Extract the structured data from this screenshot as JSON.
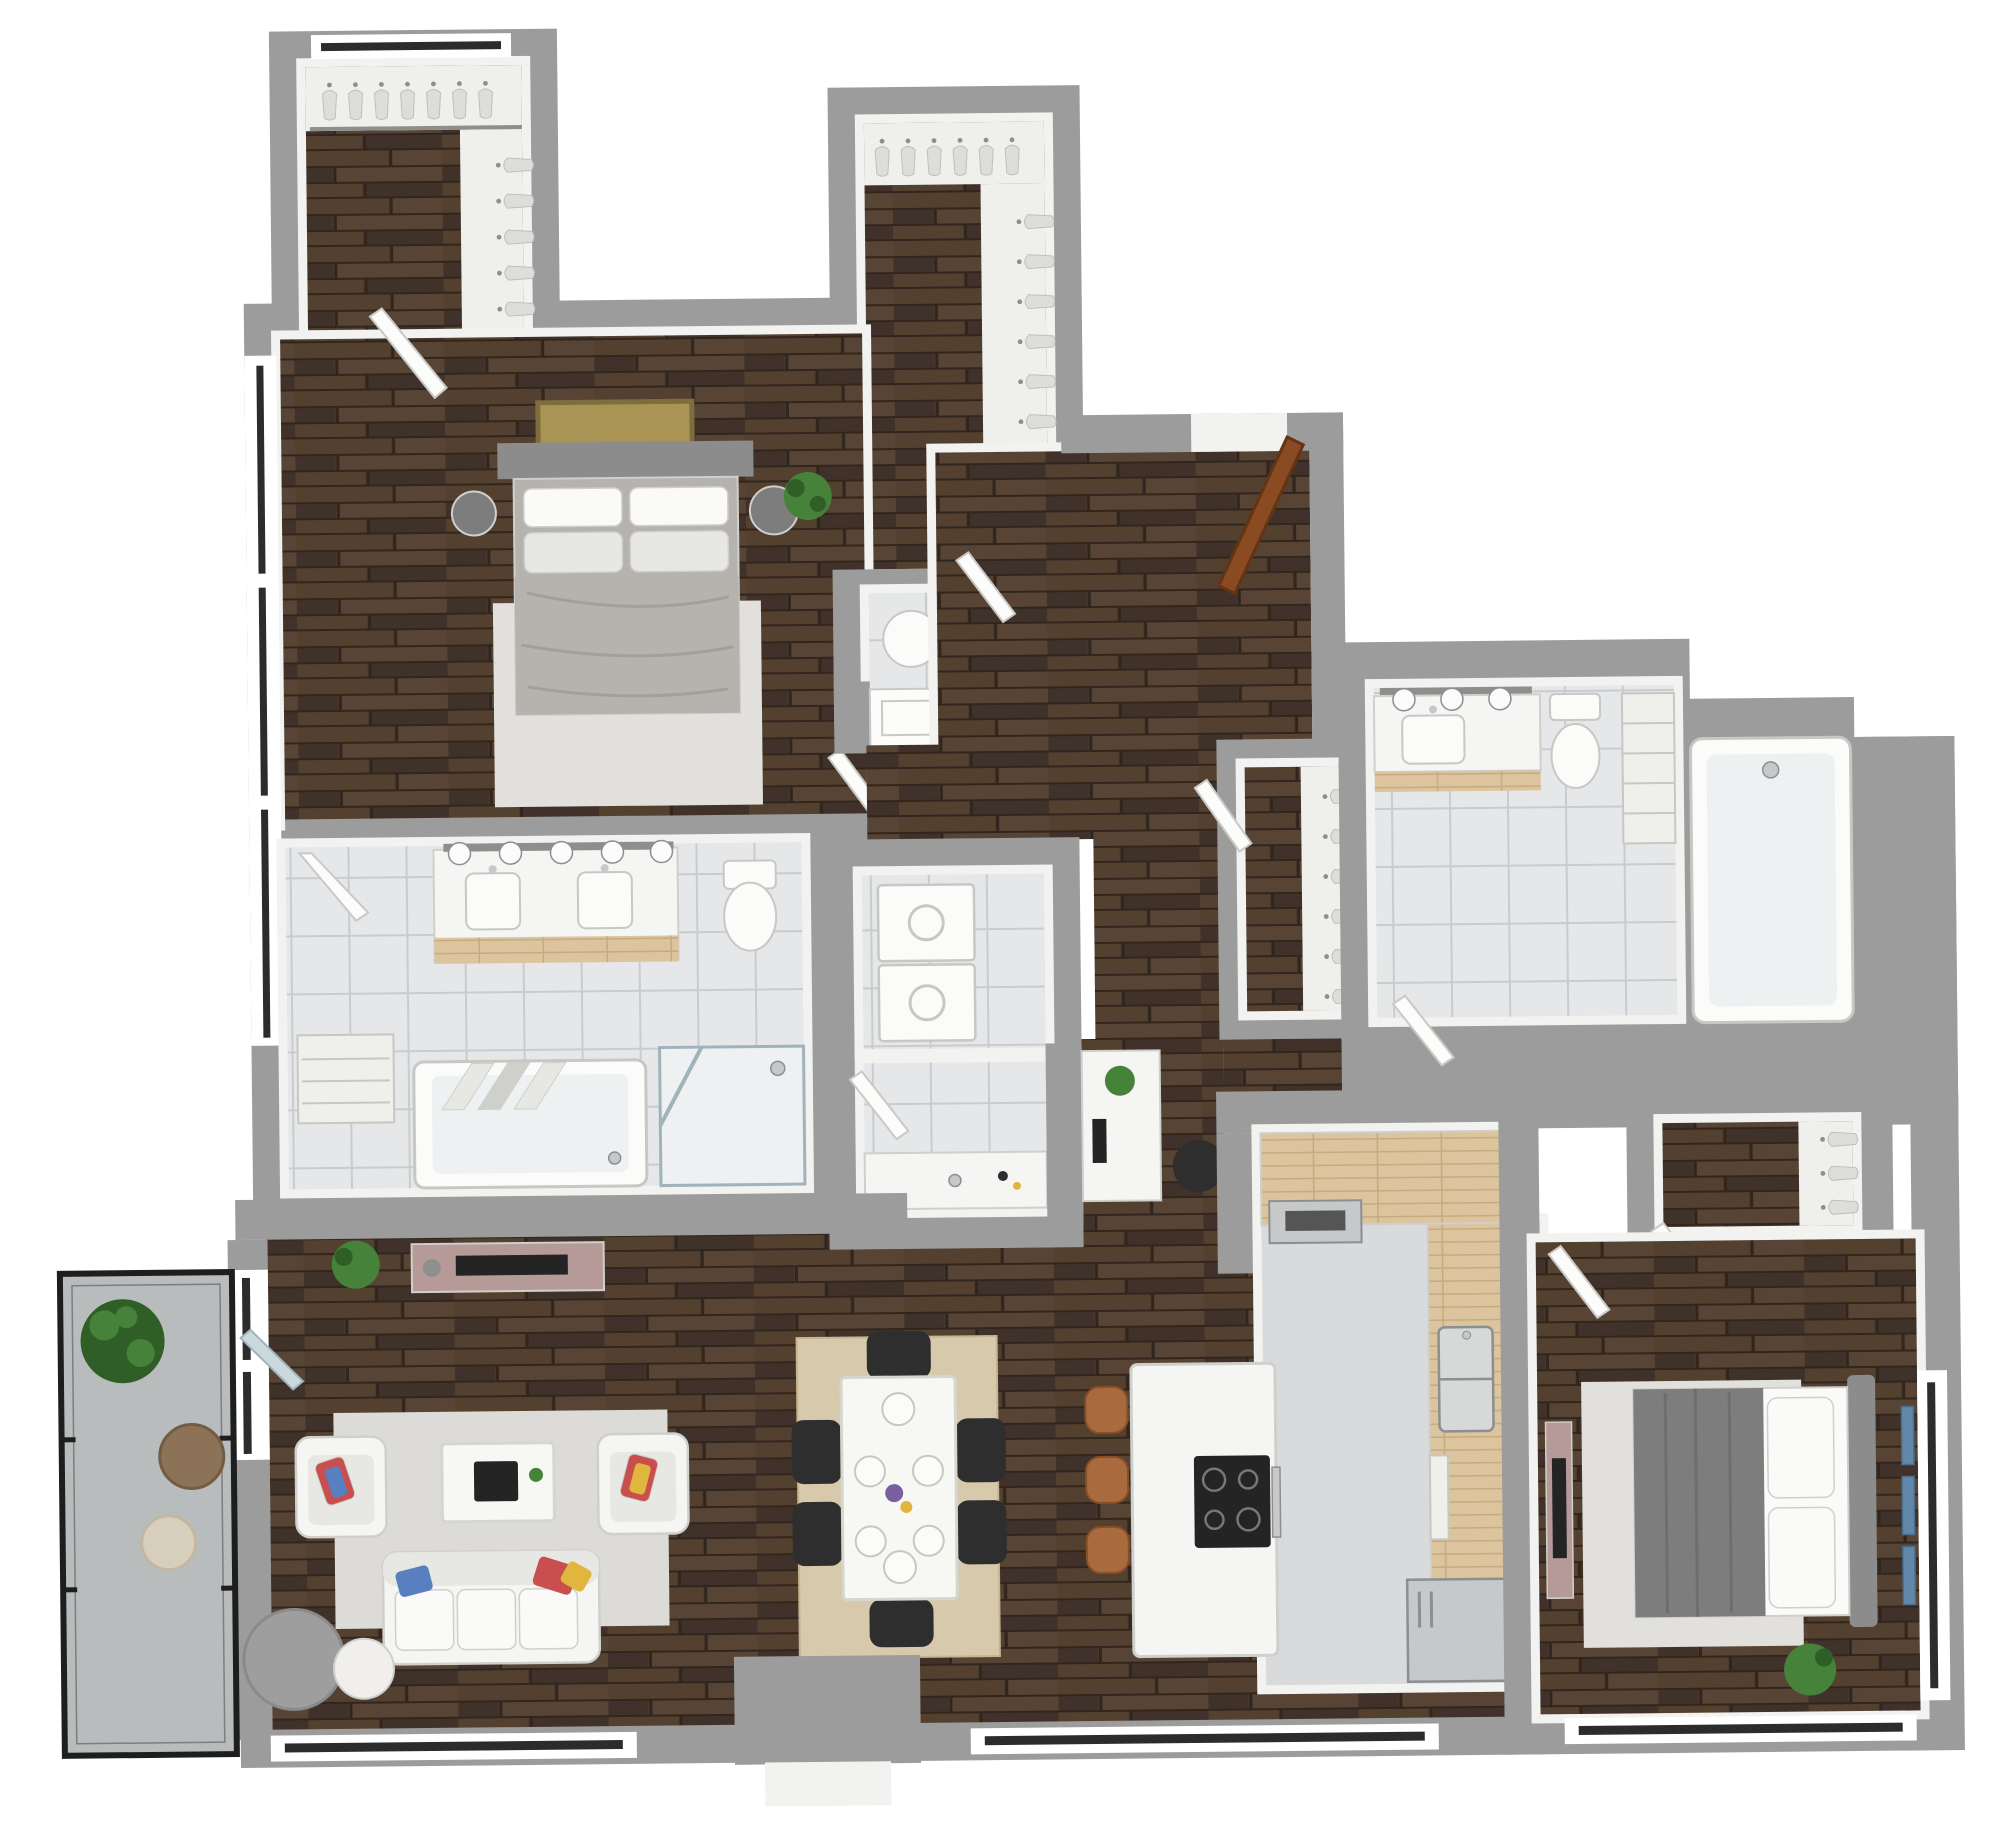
{
  "document": {
    "title": "3D Apartment Floor Plan Rendering",
    "view": "top-down 3d dollhouse render",
    "background": "#ffffff"
  },
  "colors": {
    "background": "#ffffff",
    "wall": "#9c9c9c",
    "wallFace": "#f2f2f0",
    "woodBase": "#4a392d",
    "woodPlankA": "#53402f",
    "woodPlankB": "#40322a",
    "woodPlankC": "#574434",
    "woodGap": "#31261d",
    "tileBase": "#e6e7e9",
    "tileLine": "#c9ccce",
    "counterWood": "#dcc49e",
    "counterGrain": "#c6ab7e",
    "aisleFloor": "#d9dadb",
    "balconyFloor": "#b8bcbd",
    "balconyFrame": "#1e1e1e",
    "whiteFurniture": "#f5f5f3",
    "furnitureShadow": "#cfcfcb",
    "grayDrum": "#9e9e9e",
    "black": "#2e2e2e",
    "bedHeadboard": "#8c8c8c",
    "duvetLight": "#b6b3af",
    "duvetDark": "#7d7d7d",
    "pillowWhite": "#fafaf9",
    "cushionGray": "#e7e7e3",
    "rugLight": "#dcdbd7",
    "rugJute": "#d7c9ab",
    "rugBedroom": "#e1e0dc",
    "mauve": "#b69a98",
    "tvBlack": "#242424",
    "plantGreen": "#47823a",
    "plantDark": "#2f5f27",
    "doorBrown": "#8a4a22",
    "doorLeafWhite": "#fcfcfb",
    "doorLeafEdge": "#c9c9c6",
    "glassBlue": "#ccd9dc",
    "glassLine": "#9fb4ba",
    "steel": "#c6c8c9",
    "steelDark": "#8b8f91",
    "artGold": "#a99455",
    "artGoldFrame": "#7e6e3e",
    "artBlue": "#6188a8",
    "marble": "#f7f7f4",
    "marbleVein": "#d6d6d1",
    "windowGlass": "#2c2c2c",
    "windowSill": "#ffffff",
    "clothesBody": "#dedddb",
    "clothesEdge": "#bfbfbc",
    "rodGray": "#8e8e8c",
    "stoolBrown": "#a96a3e",
    "stoolEdge": "#854f28",
    "accentRed": "#c94f4f",
    "accentBlue": "#5a7fc0",
    "accentYellow": "#e0b63f",
    "fixtureWhite": "#fbfbfa",
    "fixtureEdge": "#c7c7c4",
    "shelf": "#efefec",
    "sinkSteel": "#d7d8d8"
  },
  "semantics": {
    "rooms": [
      {
        "id": "primary-walk-in-closet",
        "contents": [
          "hanging-clothes",
          "shelving"
        ]
      },
      {
        "id": "second-walk-in-closet",
        "contents": [
          "hanging-clothes",
          "shelving"
        ]
      },
      {
        "id": "primary-bedroom",
        "contents": [
          "bed",
          "nightstands",
          "wall-art",
          "rug",
          "plant",
          "windows"
        ]
      },
      {
        "id": "primary-bathroom",
        "contents": [
          "double-vanity",
          "vanity-lights",
          "toilet",
          "bathtub",
          "glass-shower",
          "linen-shelves"
        ]
      },
      {
        "id": "storage-room",
        "contents": [
          "laundry-hamper",
          "cabinet",
          "double-door-closet"
        ]
      },
      {
        "id": "laundry-room",
        "contents": [
          "stacked-washer-dryer"
        ]
      },
      {
        "id": "powder-vanity-nook",
        "contents": [
          "vanity-sink"
        ]
      },
      {
        "id": "entry-hall",
        "contents": [
          "front-door"
        ]
      },
      {
        "id": "coat-closet",
        "contents": [
          "hanging-clothes"
        ]
      },
      {
        "id": "bathroom-2",
        "contents": [
          "vanity",
          "vanity-lights",
          "toilet",
          "linen-shelves",
          "bathtub-shower"
        ]
      },
      {
        "id": "desk-nook",
        "contents": [
          "desk",
          "office-chair",
          "plant"
        ]
      },
      {
        "id": "kitchen",
        "contents": [
          "l-shaped-counter",
          "wall-oven",
          "double-sink",
          "island-cooktop",
          "bar-stools",
          "refrigerator"
        ]
      },
      {
        "id": "dining-area",
        "contents": [
          "marble-table",
          "six-black-chairs",
          "jute-rug",
          "place-settings"
        ]
      },
      {
        "id": "living-room",
        "contents": [
          "sofa",
          "two-armchairs",
          "coffee-table",
          "tv-console",
          "rug",
          "drum-table",
          "pouf",
          "plant"
        ]
      },
      {
        "id": "bedroom-2",
        "contents": [
          "bed",
          "dresser-tv",
          "wall-art",
          "rug",
          "plant",
          "walk-in-closet",
          "windows"
        ]
      },
      {
        "id": "balcony",
        "contents": [
          "plant",
          "round-table",
          "pouf",
          "glass-railing",
          "sliding-door"
        ]
      }
    ]
  }
}
